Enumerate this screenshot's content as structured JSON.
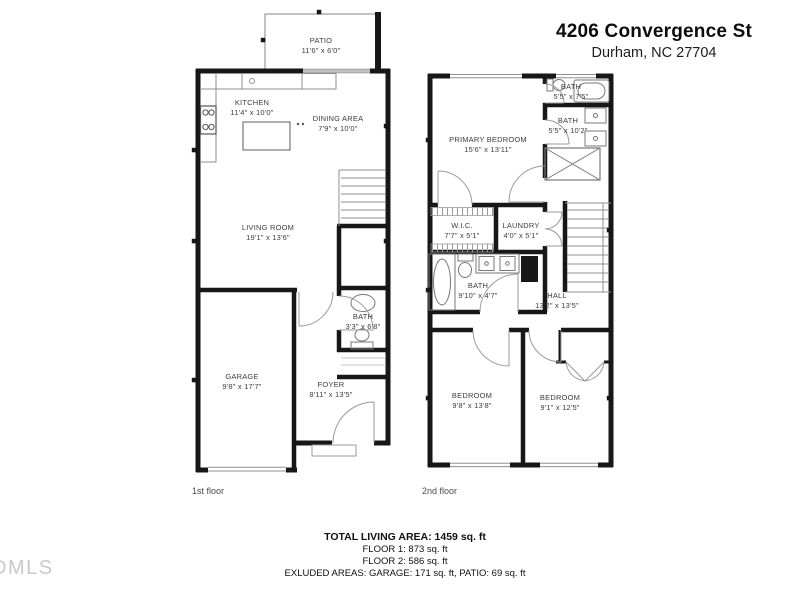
{
  "header": {
    "title": "4206 Convergence St",
    "subtitle": "Durham, NC 27704"
  },
  "floor1": {
    "caption": "1st floor",
    "rooms": {
      "patio": {
        "name": "PATIO",
        "dims": "11'6\" x 6'0\""
      },
      "kitchen": {
        "name": "KITCHEN",
        "dims": "11'4\" x 10'0\""
      },
      "dining": {
        "name": "DINING AREA",
        "dims": "7'9\" x 10'0\""
      },
      "living": {
        "name": "LIVING ROOM",
        "dims": "19'1\" x 13'6\""
      },
      "bath": {
        "name": "BATH",
        "dims": "3'3\" x 6'8\""
      },
      "garage": {
        "name": "GARAGE",
        "dims": "9'8\" x 17'7\""
      },
      "foyer": {
        "name": "FOYER",
        "dims": "8'11\" x 13'5\""
      }
    }
  },
  "floor2": {
    "caption": "2nd floor",
    "rooms": {
      "bath_top": {
        "name": "BATH",
        "dims": "5'5\" x 7'5\""
      },
      "bath_upper": {
        "name": "BATH",
        "dims": "5'5\" x 10'2\""
      },
      "primary": {
        "name": "PRIMARY BEDROOM",
        "dims": "15'6\" x 13'11\""
      },
      "wic": {
        "name": "W.I.C.",
        "dims": "7'7\" x 5'1\""
      },
      "laundry": {
        "name": "LAUNDRY",
        "dims": "4'0\" x 5'1\""
      },
      "bath_main": {
        "name": "BATH",
        "dims": "9'10\" x 4'7\""
      },
      "hall": {
        "name": "HALL",
        "dims": "13'2\" x 13'5\""
      },
      "bedroom_left": {
        "name": "BEDROOM",
        "dims": "9'8\" x 13'8\""
      },
      "bedroom_right": {
        "name": "BEDROOM",
        "dims": "9'1\" x 12'5\""
      }
    }
  },
  "summary": {
    "total": "TOTAL LIVING AREA: 1459 sq. ft",
    "floor1": "FLOOR 1: 873 sq. ft",
    "floor2": "FLOOR 2: 586 sq. ft",
    "excluded": "EXLUDED AREAS: GARAGE: 171 sq. ft, PATIO: 69 sq. ft"
  },
  "watermark": "DMLS",
  "colors": {
    "wall": "#171717",
    "fixture": "#8f8f8f",
    "door_arc": "#9a9a9a",
    "label": "#3d3d3d"
  }
}
